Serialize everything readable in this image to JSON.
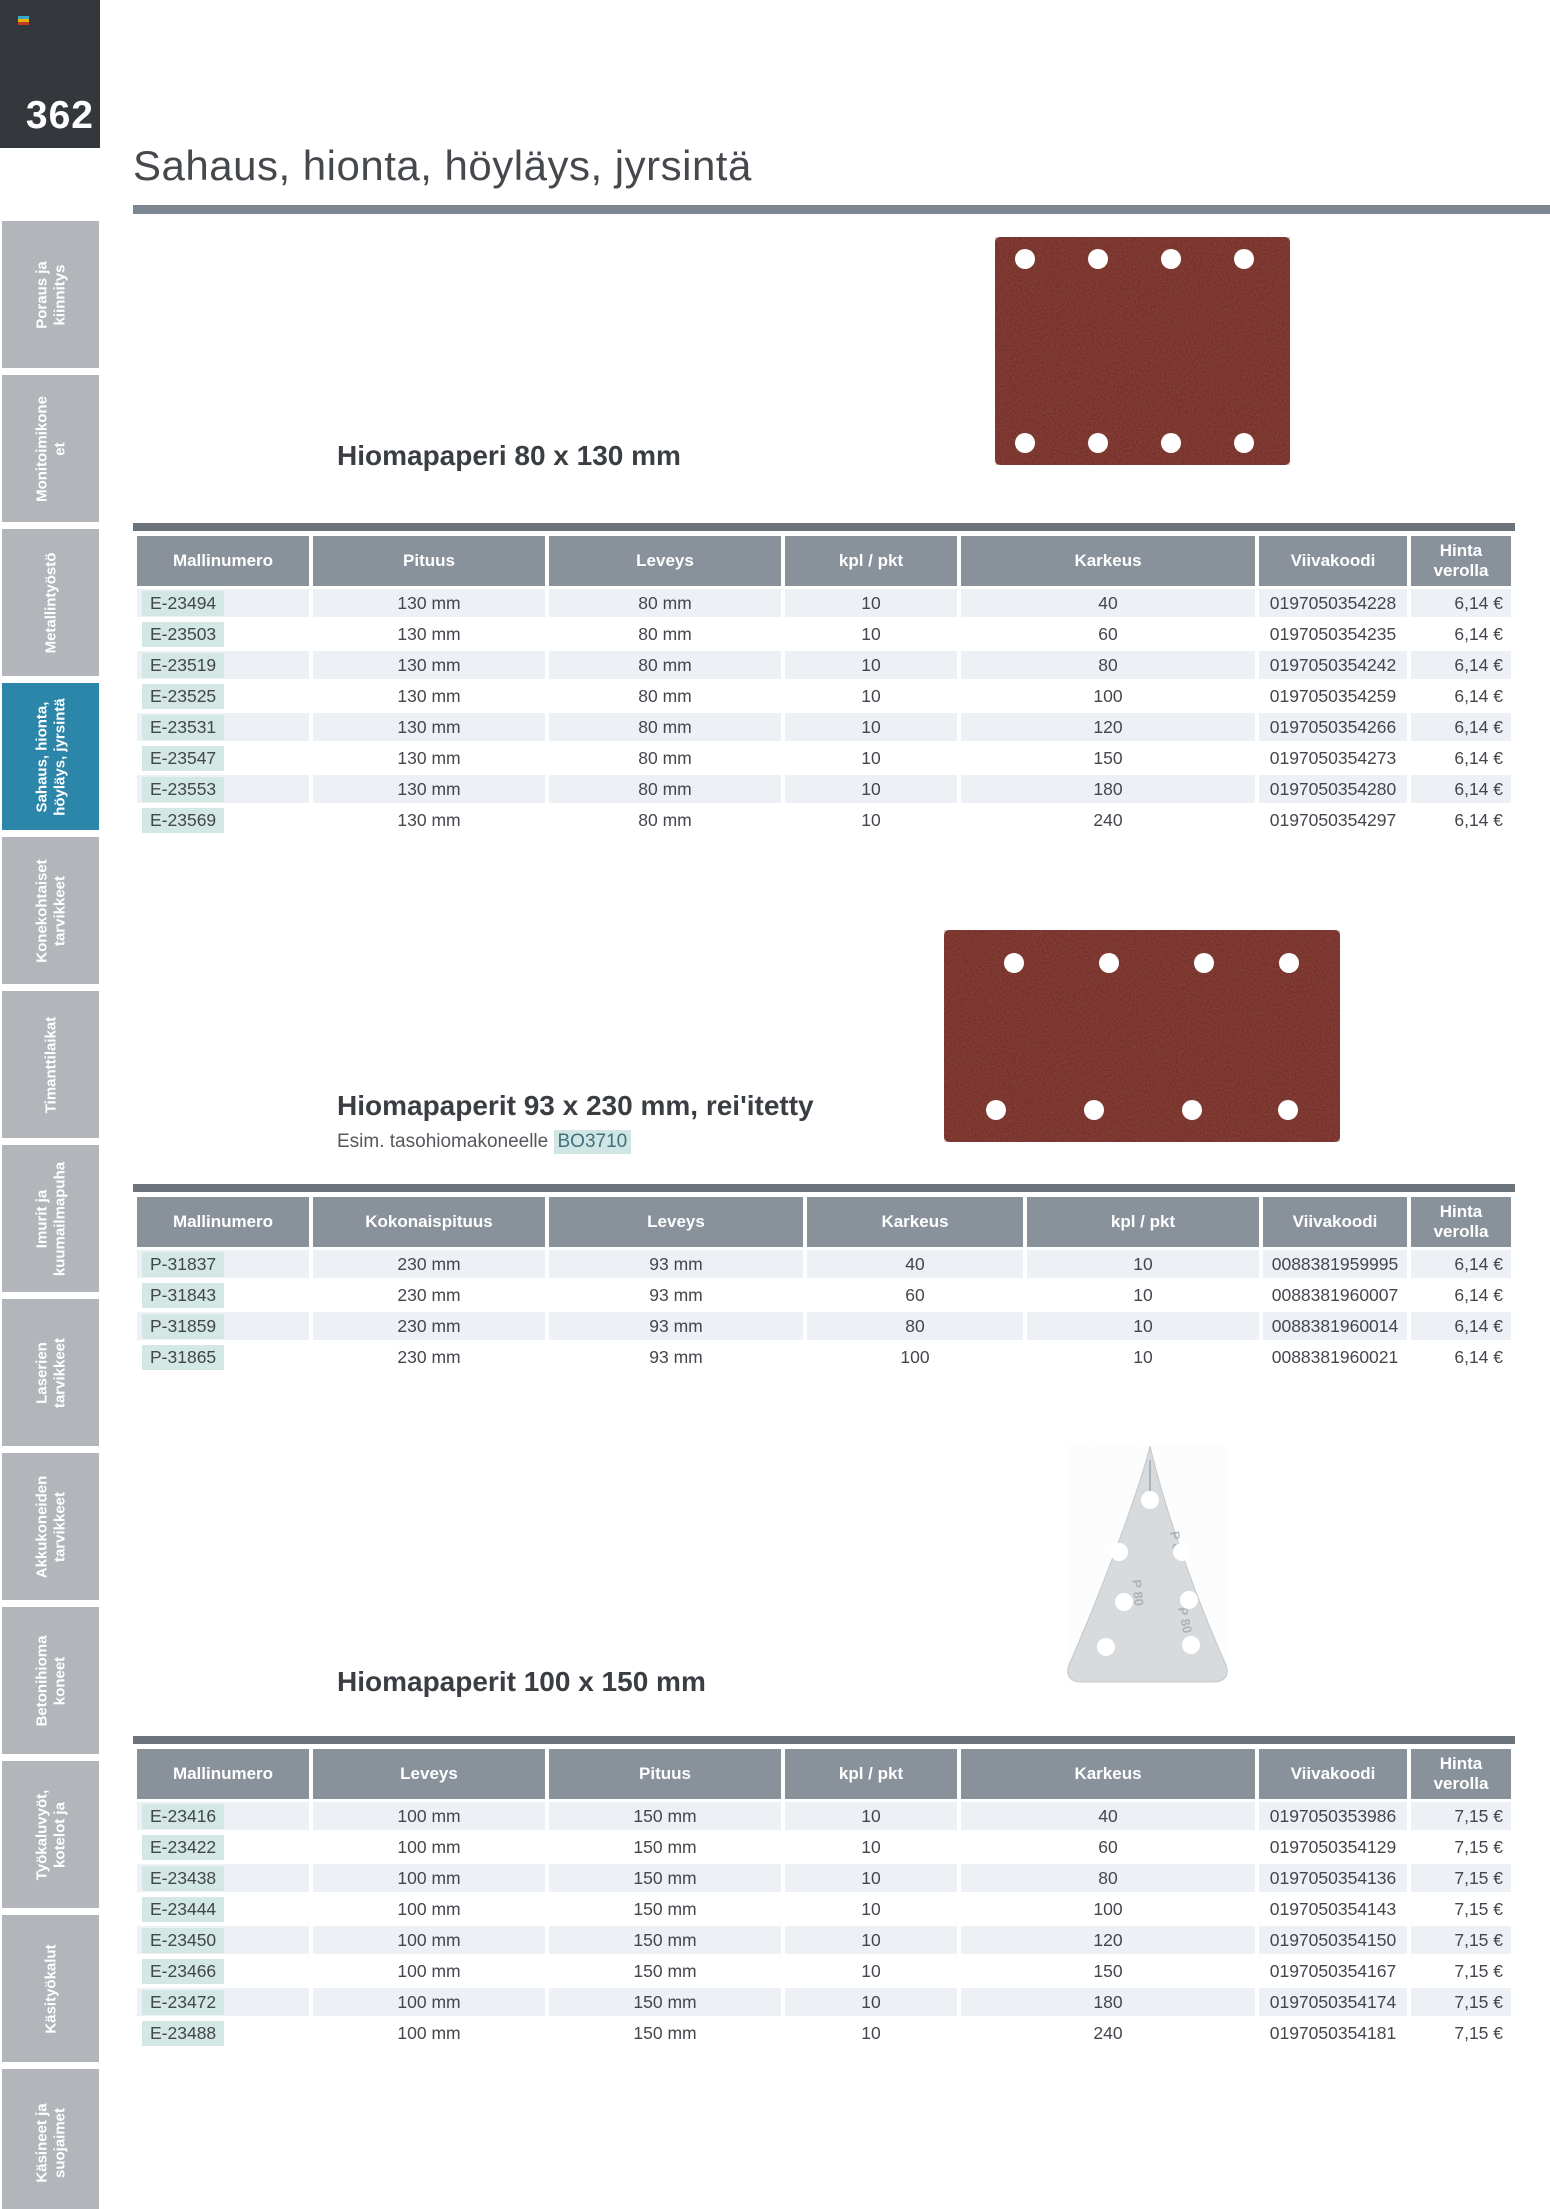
{
  "page": {
    "number": "362",
    "title": "Sahaus, hionta, höyläys, jyrsintä"
  },
  "colors": {
    "accent_teal": "#2c86aa",
    "model_highlight": "#d3e7e4",
    "table_header_gray": "#89919b",
    "table_top_bar": "#6d737a",
    "row_stripe": "#edf0f4",
    "title_rule": "#7d8791",
    "page_number_box": "#34383c",
    "sandpaper_red": "#8c372e",
    "delta_sheet_gray": "#d9dcde"
  },
  "icons": {
    "logo": "catalog-logo-stripes"
  },
  "sidebar": {
    "items": [
      {
        "lines": [
          "Poraus ja",
          "kiinnitys"
        ],
        "active": false
      },
      {
        "lines": [
          "Monitoimikone",
          "et"
        ],
        "active": false
      },
      {
        "lines": [
          "Metallintyöstö"
        ],
        "active": false
      },
      {
        "lines": [
          "Sahaus, hionta,",
          "höyläys, jyrsintä"
        ],
        "active": true
      },
      {
        "lines": [
          "Konekohtaiset",
          "tarvikkeet"
        ],
        "active": false
      },
      {
        "lines": [
          "Timanttilaikat"
        ],
        "active": false
      },
      {
        "lines": [
          "Imurit ja",
          "kuumailmapuha"
        ],
        "active": false
      },
      {
        "lines": [
          "Laserien",
          "tarvikkeet"
        ],
        "active": false
      },
      {
        "lines": [
          "Akkukoneiden",
          "tarvikkeet"
        ],
        "active": false
      },
      {
        "lines": [
          "Betonihioma",
          "koneet"
        ],
        "active": false
      },
      {
        "lines": [
          "Työkaluvyöt,",
          "kotelot ja"
        ],
        "active": false
      },
      {
        "lines": [
          "Käsityökalut"
        ],
        "active": false
      },
      {
        "lines": [
          "Käsineet ja",
          "suojaimet"
        ],
        "active": false
      }
    ]
  },
  "sections": [
    {
      "heading": "Hiomapaperi 80 x 130 mm",
      "table": {
        "columns": [
          "Mallinumero",
          "Pituus",
          "Leveys",
          "kpl / pkt",
          "Karkeus",
          "Viivakoodi",
          "Hinta verolla"
        ],
        "rows": [
          [
            "E-23494",
            "130 mm",
            "80 mm",
            "10",
            "40",
            "0197050354228",
            "6,14 €"
          ],
          [
            "E-23503",
            "130 mm",
            "80 mm",
            "10",
            "60",
            "0197050354235",
            "6,14 €"
          ],
          [
            "E-23519",
            "130 mm",
            "80 mm",
            "10",
            "80",
            "0197050354242",
            "6,14 €"
          ],
          [
            "E-23525",
            "130 mm",
            "80 mm",
            "10",
            "100",
            "0197050354259",
            "6,14 €"
          ],
          [
            "E-23531",
            "130 mm",
            "80 mm",
            "10",
            "120",
            "0197050354266",
            "6,14 €"
          ],
          [
            "E-23547",
            "130 mm",
            "80 mm",
            "10",
            "150",
            "0197050354273",
            "6,14 €"
          ],
          [
            "E-23553",
            "130 mm",
            "80 mm",
            "10",
            "180",
            "0197050354280",
            "6,14 €"
          ],
          [
            "E-23569",
            "130 mm",
            "80 mm",
            "10",
            "240",
            "0197050354297",
            "6,14 €"
          ]
        ]
      }
    },
    {
      "heading": "Hiomapaperit 93 x 230 mm, rei'itetty",
      "subheading_prefix": "Esim. tasohiomakoneelle",
      "subheading_link": "BO3710",
      "table": {
        "columns": [
          "Mallinumero",
          "Kokonaispituus",
          "Leveys",
          "Karkeus",
          "kpl / pkt",
          "Viivakoodi",
          "Hinta verolla"
        ],
        "rows": [
          [
            "P-31837",
            "230 mm",
            "93 mm",
            "40",
            "10",
            "0088381959995",
            "6,14 €"
          ],
          [
            "P-31843",
            "230 mm",
            "93 mm",
            "60",
            "10",
            "0088381960007",
            "6,14 €"
          ],
          [
            "P-31859",
            "230 mm",
            "93 mm",
            "80",
            "10",
            "0088381960014",
            "6,14 €"
          ],
          [
            "P-31865",
            "230 mm",
            "93 mm",
            "100",
            "10",
            "0088381960021",
            "6,14 €"
          ]
        ]
      }
    },
    {
      "heading": "Hiomapaperit 100 x 150 mm",
      "table": {
        "columns": [
          "Mallinumero",
          "Leveys",
          "Pituus",
          "kpl / pkt",
          "Karkeus",
          "Viivakoodi",
          "Hinta verolla"
        ],
        "rows": [
          [
            "E-23416",
            "100 mm",
            "150 mm",
            "10",
            "40",
            "0197050353986",
            "7,15 €"
          ],
          [
            "E-23422",
            "100 mm",
            "150 mm",
            "10",
            "60",
            "0197050354129",
            "7,15 €"
          ],
          [
            "E-23438",
            "100 mm",
            "150 mm",
            "10",
            "80",
            "0197050354136",
            "7,15 €"
          ],
          [
            "E-23444",
            "100 mm",
            "150 mm",
            "10",
            "100",
            "0197050354143",
            "7,15 €"
          ],
          [
            "E-23450",
            "100 mm",
            "150 mm",
            "10",
            "120",
            "0197050354150",
            "7,15 €"
          ],
          [
            "E-23466",
            "100 mm",
            "150 mm",
            "10",
            "150",
            "0197050354167",
            "7,15 €"
          ],
          [
            "E-23472",
            "100 mm",
            "150 mm",
            "10",
            "180",
            "0197050354174",
            "7,15 €"
          ],
          [
            "E-23488",
            "100 mm",
            "150 mm",
            "10",
            "240",
            "0197050354181",
            "7,15 €"
          ]
        ]
      }
    }
  ]
}
